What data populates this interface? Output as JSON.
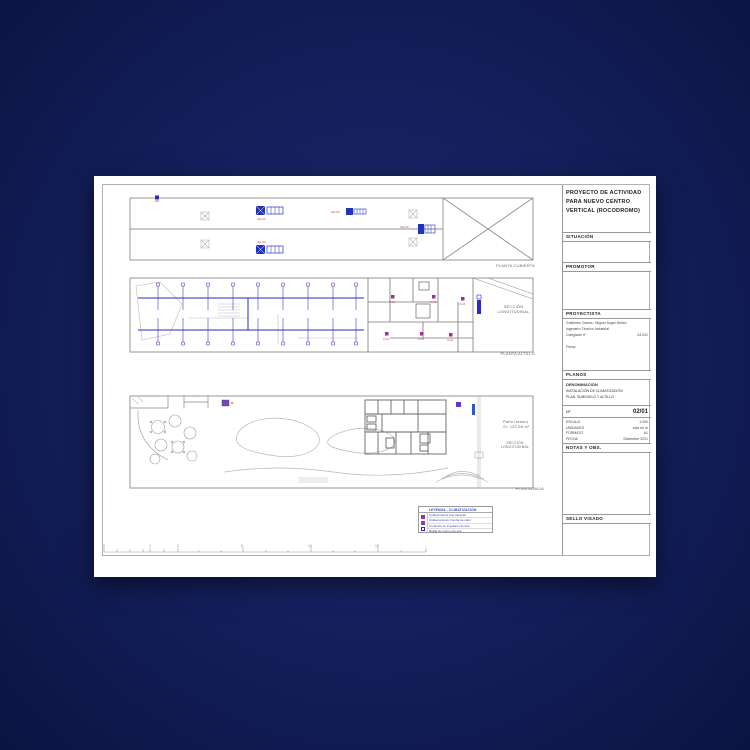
{
  "window": {
    "background_center": "#1e2c74",
    "background_edge": "#0b1442"
  },
  "sheet": {
    "title_block": {
      "project_title": "PROYECTO DE ACTIVIDAD PARA NUEVO CENTRO VERTICAL (ROCODROMO)",
      "situacion": {
        "label": "SITUACIÓN"
      },
      "promotor": {
        "label": "PROMOTOR"
      },
      "proyectista": {
        "label": "PROYECTISTA",
        "name_line": "Guillermo García / Miguel Ángel Núñez",
        "title_line": "Ingeniero Técnico Industrial",
        "colegiado_label": "Colegiado nº",
        "colegiado_value": "04.031",
        "firma_label": "Firma:"
      },
      "planos": {
        "label": "PLANOS"
      },
      "denominacion": {
        "label": "DENOMINACIÓN",
        "line1": "INSTALACIÓN DE CLIMATIZACIÓN",
        "line2": "PLAN. SUBSUELO Y ALTILLO"
      },
      "numero": {
        "label": "Nº",
        "value": "02/01"
      },
      "specs": [
        {
          "label": "ESCALA",
          "value": "1:200"
        },
        {
          "label": "UNIDADES",
          "value": "cota en m"
        },
        {
          "label": "FORMATO",
          "value": "A1"
        },
        {
          "label": "FECHA",
          "value": "Diciembre 2021"
        }
      ],
      "notas": {
        "label": "NOTAS Y OBS."
      },
      "sello": {
        "label": "SELLO VISADO"
      }
    },
    "plans": {
      "cubierta": {
        "caption": "PLANTA CUBIERTA"
      },
      "altillo": {
        "caption": "PLANTA ALTILLO",
        "section_line1": "SECCIÓN",
        "section_line2": "LONGITUDINAL"
      },
      "baja": {
        "caption": "PLANTA BAJA",
        "section_line1": "SECCIÓN",
        "section_line2": "LONGITUDINAL",
        "patio_line1": "Patio trasero",
        "patio_line2": "S= 122,56 m²"
      },
      "exterior_unit_labels": [
        "UE-01",
        "UE-02",
        "UE-03",
        "UE-04"
      ],
      "interior_unit_labels": [
        "UI-01",
        "UI-02",
        "UI-03",
        "UI-04",
        "UI-05",
        "UI-06"
      ]
    },
    "legend": {
      "title": "LEYENDA - CLIMATIZACIÓN",
      "rows": [
        {
          "text": "Unidad interior tipo cassette"
        },
        {
          "text": "Unidad exterior bomba de calor"
        },
        {
          "text": "Conducto de impulsión de aire"
        },
        {
          "text": "Rejilla de retorno de aire"
        }
      ]
    },
    "scale_bar": {
      "labels": [
        "0",
        "1",
        "2",
        "5",
        "10",
        "15"
      ]
    }
  },
  "colors": {
    "duct_blue": "#2a2ac8",
    "unit_blue": "#2233bb",
    "fancoil_magenta": "#993399",
    "label_red": "#cc4444",
    "line_gray": "#8a8a8a"
  }
}
